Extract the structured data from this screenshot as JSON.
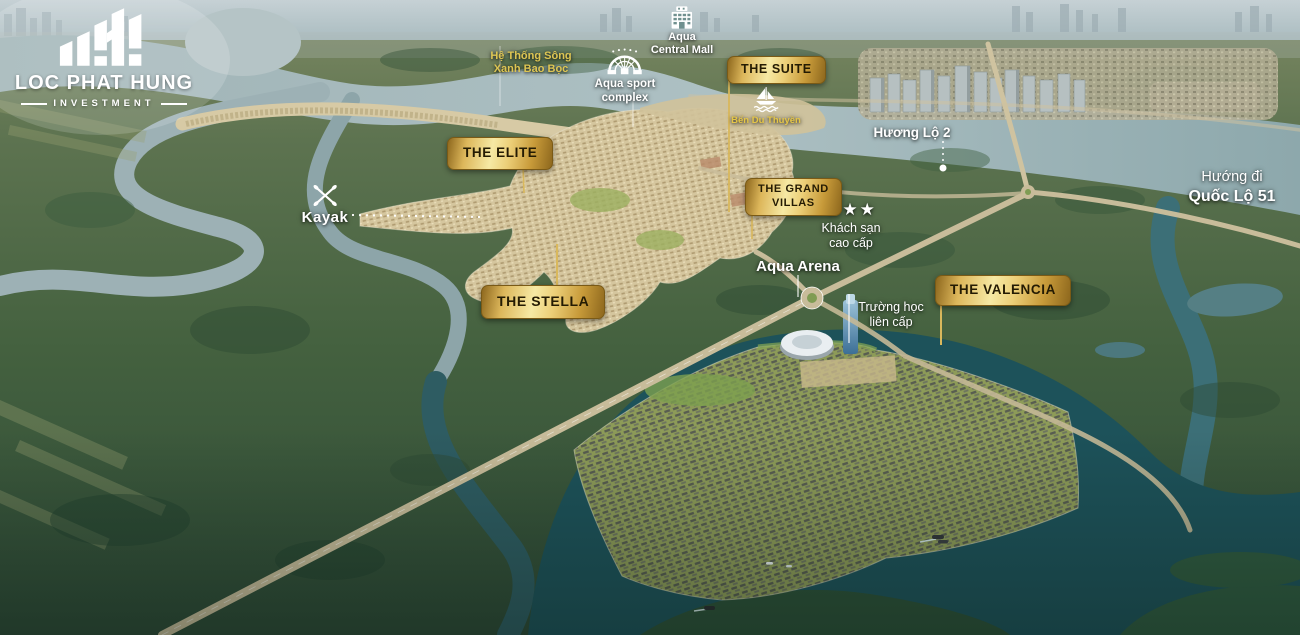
{
  "logo": {
    "company": "LOC PHAT HUNG",
    "subtitle": "INVESTMENT",
    "icon": "bar-chart-logo-mark"
  },
  "zone_badges": [
    {
      "id": "the-suite",
      "label": "THE SUITE"
    },
    {
      "id": "the-elite",
      "label": "THE ELITE"
    },
    {
      "id": "the-grand-villas",
      "line1": "THE GRAND",
      "line2": "VILLAS"
    },
    {
      "id": "the-stella",
      "label": "THE STELLA"
    },
    {
      "id": "the-valencia",
      "label": "THE VALENCIA"
    }
  ],
  "pois": {
    "river_system": {
      "line1": "Hệ Thống Sông",
      "line2": "Xanh Bao Bọc"
    },
    "central_mall": {
      "icon": "mall-building-icon",
      "line1": "Aqua",
      "line2": "Central Mall"
    },
    "sport_complex": {
      "icon": "stadium-icon",
      "line1": "Aqua sport",
      "line2": "complex"
    },
    "marina": {
      "icon": "sailboat-icon",
      "label": "Bến Du Thuyền"
    },
    "kayak": {
      "icon": "kayak-paddles-icon",
      "label": "Kayak"
    },
    "hotel": {
      "icon": "three-star-rating",
      "stars": "★★★",
      "line1": "Khách sạn",
      "line2": "cao cấp"
    },
    "arena": {
      "label": "Aqua Arena"
    },
    "school": {
      "line1": "Trường học",
      "line2": "liên cấp"
    }
  },
  "roads": {
    "huong_lo_2": {
      "label": "Hương Lộ 2"
    },
    "quoc_lo_51": {
      "line1": "Hướng đi",
      "line2": "Quốc Lộ 51"
    }
  },
  "colors": {
    "badge_gold": "#d9ae4a",
    "label_yellow": "#ddc553",
    "water_light": "#a3b8bd",
    "water_dark": "#1d525a",
    "land_green": "#44613f",
    "island_tan": "#d2c49e"
  }
}
